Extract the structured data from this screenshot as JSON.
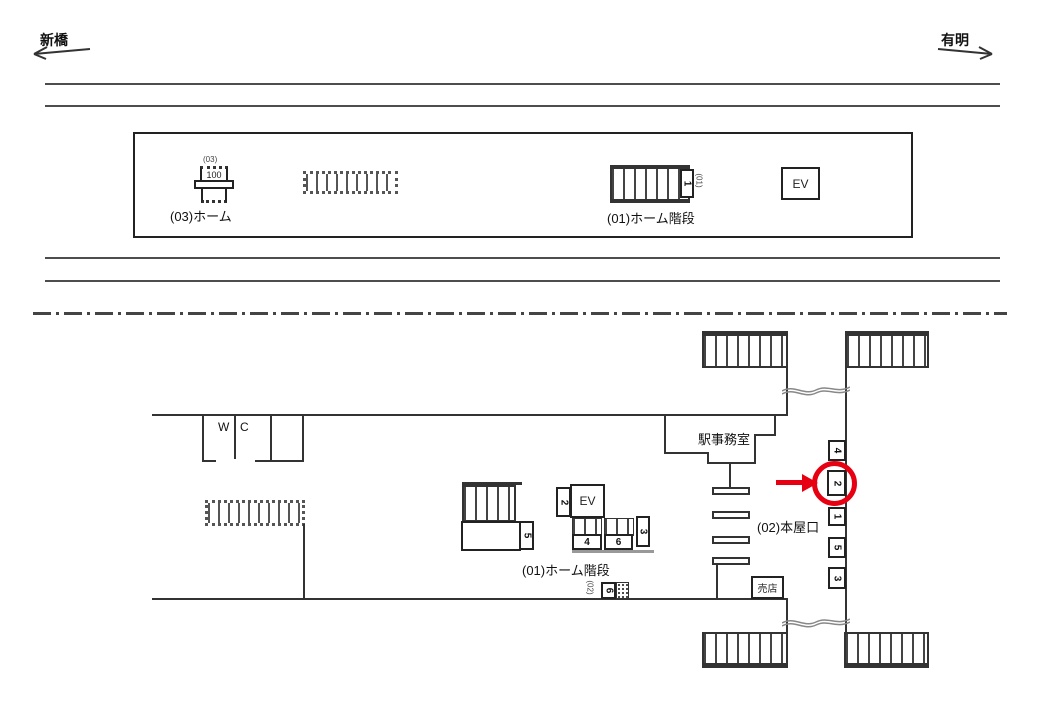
{
  "colors": {
    "accent_red": "#e60012",
    "line_dark": "#333333"
  },
  "header": {
    "left_station": "新橋",
    "right_station": "有明"
  },
  "platform": {
    "unit03_tag": "(03)",
    "unit03_value": "100",
    "unit03_label": "(03)ホーム",
    "stairs_label": "(01)ホーム階段",
    "stairs_tag": "(01)",
    "stairs_slot": "1",
    "ev_label": "EV"
  },
  "concourse": {
    "wc_left": "W",
    "wc_right": "C",
    "office_label": "駅事務室",
    "stairs_label": "(01)ホーム階段",
    "ev_label": "EV",
    "slot_2": "2",
    "slot_5": "5",
    "slot_4": "4",
    "slot_6": "6",
    "slot_3": "3",
    "exit_tag": "(02)",
    "exit_slot": "6",
    "exit_label": "(02)本屋口",
    "kiosk_label": "売店",
    "wall_slots": [
      {
        "n": "4"
      },
      {
        "n": "2"
      },
      {
        "n": "1"
      },
      {
        "n": "5"
      },
      {
        "n": "3"
      }
    ]
  }
}
